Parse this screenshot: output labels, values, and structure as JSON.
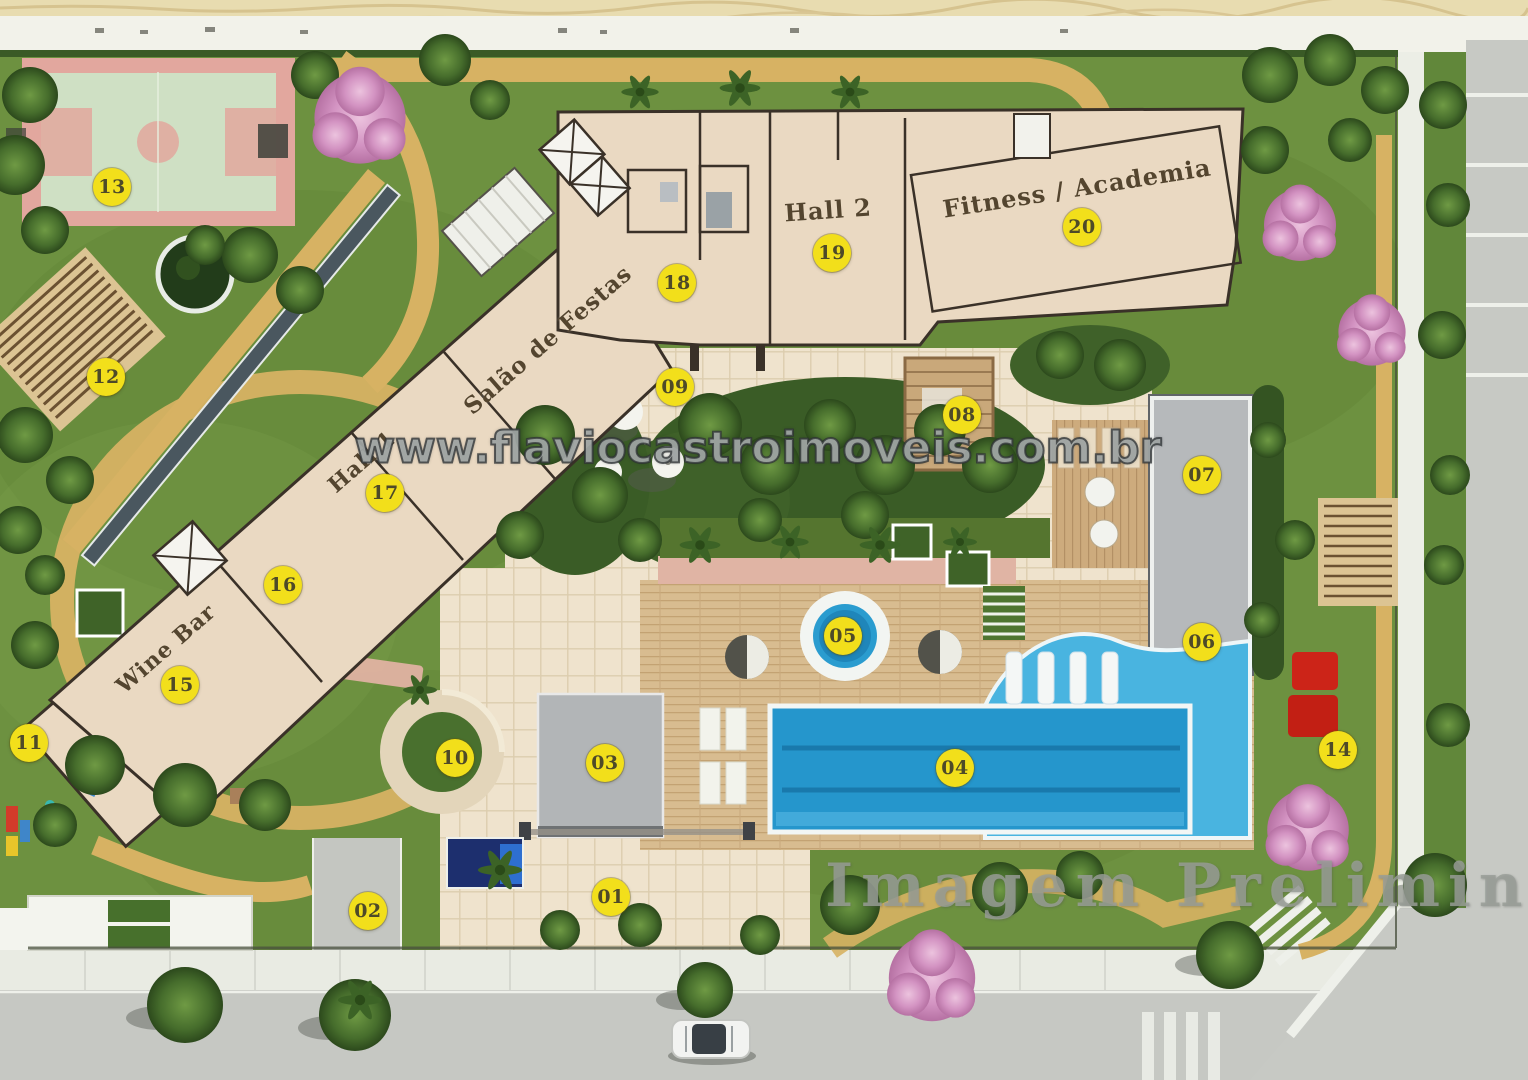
{
  "plan": {
    "watermarks": {
      "site_url": "www.flaviocastroimoveis.com.br",
      "status": "Imagem Preliminar"
    },
    "colors": {
      "marker_bg": "#f2df1b",
      "marker_text": "#4e4a28",
      "pool_blue": "#2596cc",
      "building_beige": "#ead9c2",
      "grass_green": "#6d9140",
      "path_tan": "#d7b263"
    },
    "markers": [
      {
        "num": "01",
        "x": 39.99,
        "y": 83.06
      },
      {
        "num": "02",
        "x": 24.08,
        "y": 84.35
      },
      {
        "num": "03",
        "x": 39.59,
        "y": 70.65
      },
      {
        "num": "04",
        "x": 62.5,
        "y": 71.11
      },
      {
        "num": "05",
        "x": 55.17,
        "y": 58.89
      },
      {
        "num": "06",
        "x": 78.66,
        "y": 59.44
      },
      {
        "num": "07",
        "x": 78.66,
        "y": 43.98
      },
      {
        "num": "08",
        "x": 62.96,
        "y": 38.43
      },
      {
        "num": "09",
        "x": 44.18,
        "y": 35.83
      },
      {
        "num": "10",
        "x": 29.78,
        "y": 70.19
      },
      {
        "num": "11",
        "x": 1.9,
        "y": 68.8
      },
      {
        "num": "12",
        "x": 6.94,
        "y": 34.91
      },
      {
        "num": "13",
        "x": 7.33,
        "y": 17.31
      },
      {
        "num": "14",
        "x": 87.57,
        "y": 69.44
      },
      {
        "num": "15",
        "x": 11.78,
        "y": 63.43
      },
      {
        "num": "16",
        "x": 18.52,
        "y": 54.17
      },
      {
        "num": "17",
        "x": 25.2,
        "y": 45.65
      },
      {
        "num": "18",
        "x": 44.31,
        "y": 26.2
      },
      {
        "num": "19",
        "x": 54.45,
        "y": 23.43
      },
      {
        "num": "20",
        "x": 70.81,
        "y": 21.02
      }
    ],
    "area_labels": [
      {
        "id": "salao-de-festas",
        "text": "Salão de Festas",
        "x": 35.86,
        "y": 31.48,
        "rot": -41,
        "size": 23
      },
      {
        "id": "hall-1",
        "text": "Hall 1",
        "x": 23.69,
        "y": 42.78,
        "rot": -41,
        "size": 22
      },
      {
        "id": "hall-2",
        "text": "Hall 2",
        "x": 54.19,
        "y": 19.44,
        "rot": -4,
        "size": 24
      },
      {
        "id": "fitness-academia",
        "text": "Fitness / Academia",
        "x": 70.48,
        "y": 17.41,
        "rot": -9,
        "size": 24
      },
      {
        "id": "wine-bar",
        "text": "Wine Bar",
        "x": 10.86,
        "y": 60.09,
        "rot": -41,
        "size": 22
      }
    ],
    "watermark_pos": {
      "url_x": 49.6,
      "url_y": 41.5,
      "status_x": 54.0,
      "status_y": 78.8
    }
  }
}
